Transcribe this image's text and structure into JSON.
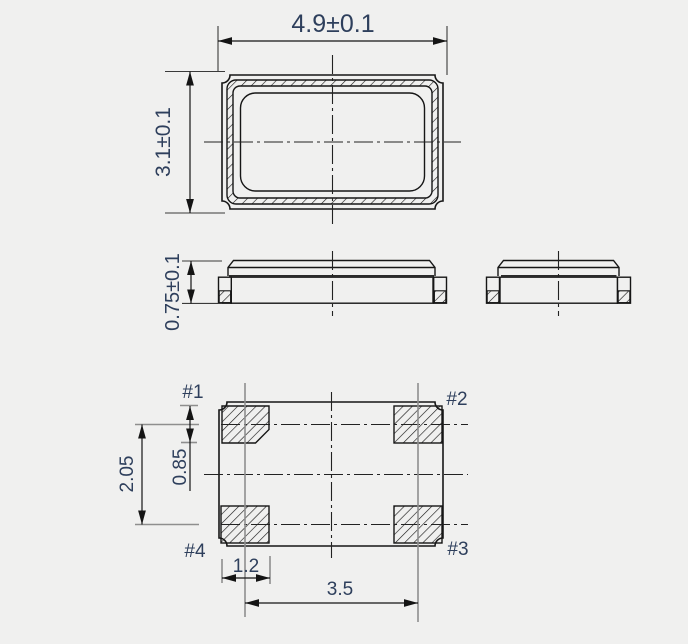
{
  "drawing": {
    "title": "package-outline-drawing",
    "colors": {
      "background": "#f0f0ef",
      "line": "#161616",
      "text": "#2e3f5c",
      "helper_line": "#8e8e8e"
    },
    "dims": {
      "width": "4.9±0.1",
      "height": "3.1±0.1",
      "thickness": "0.75±0.1",
      "pad_row_pitch": "2.05",
      "pad_size_y": "0.85",
      "pad_size_x": "1.2",
      "pad_col_pitch": "3.5"
    },
    "pads": {
      "p1": "#1",
      "p2": "#2",
      "p3": "#3",
      "p4": "#4"
    }
  }
}
